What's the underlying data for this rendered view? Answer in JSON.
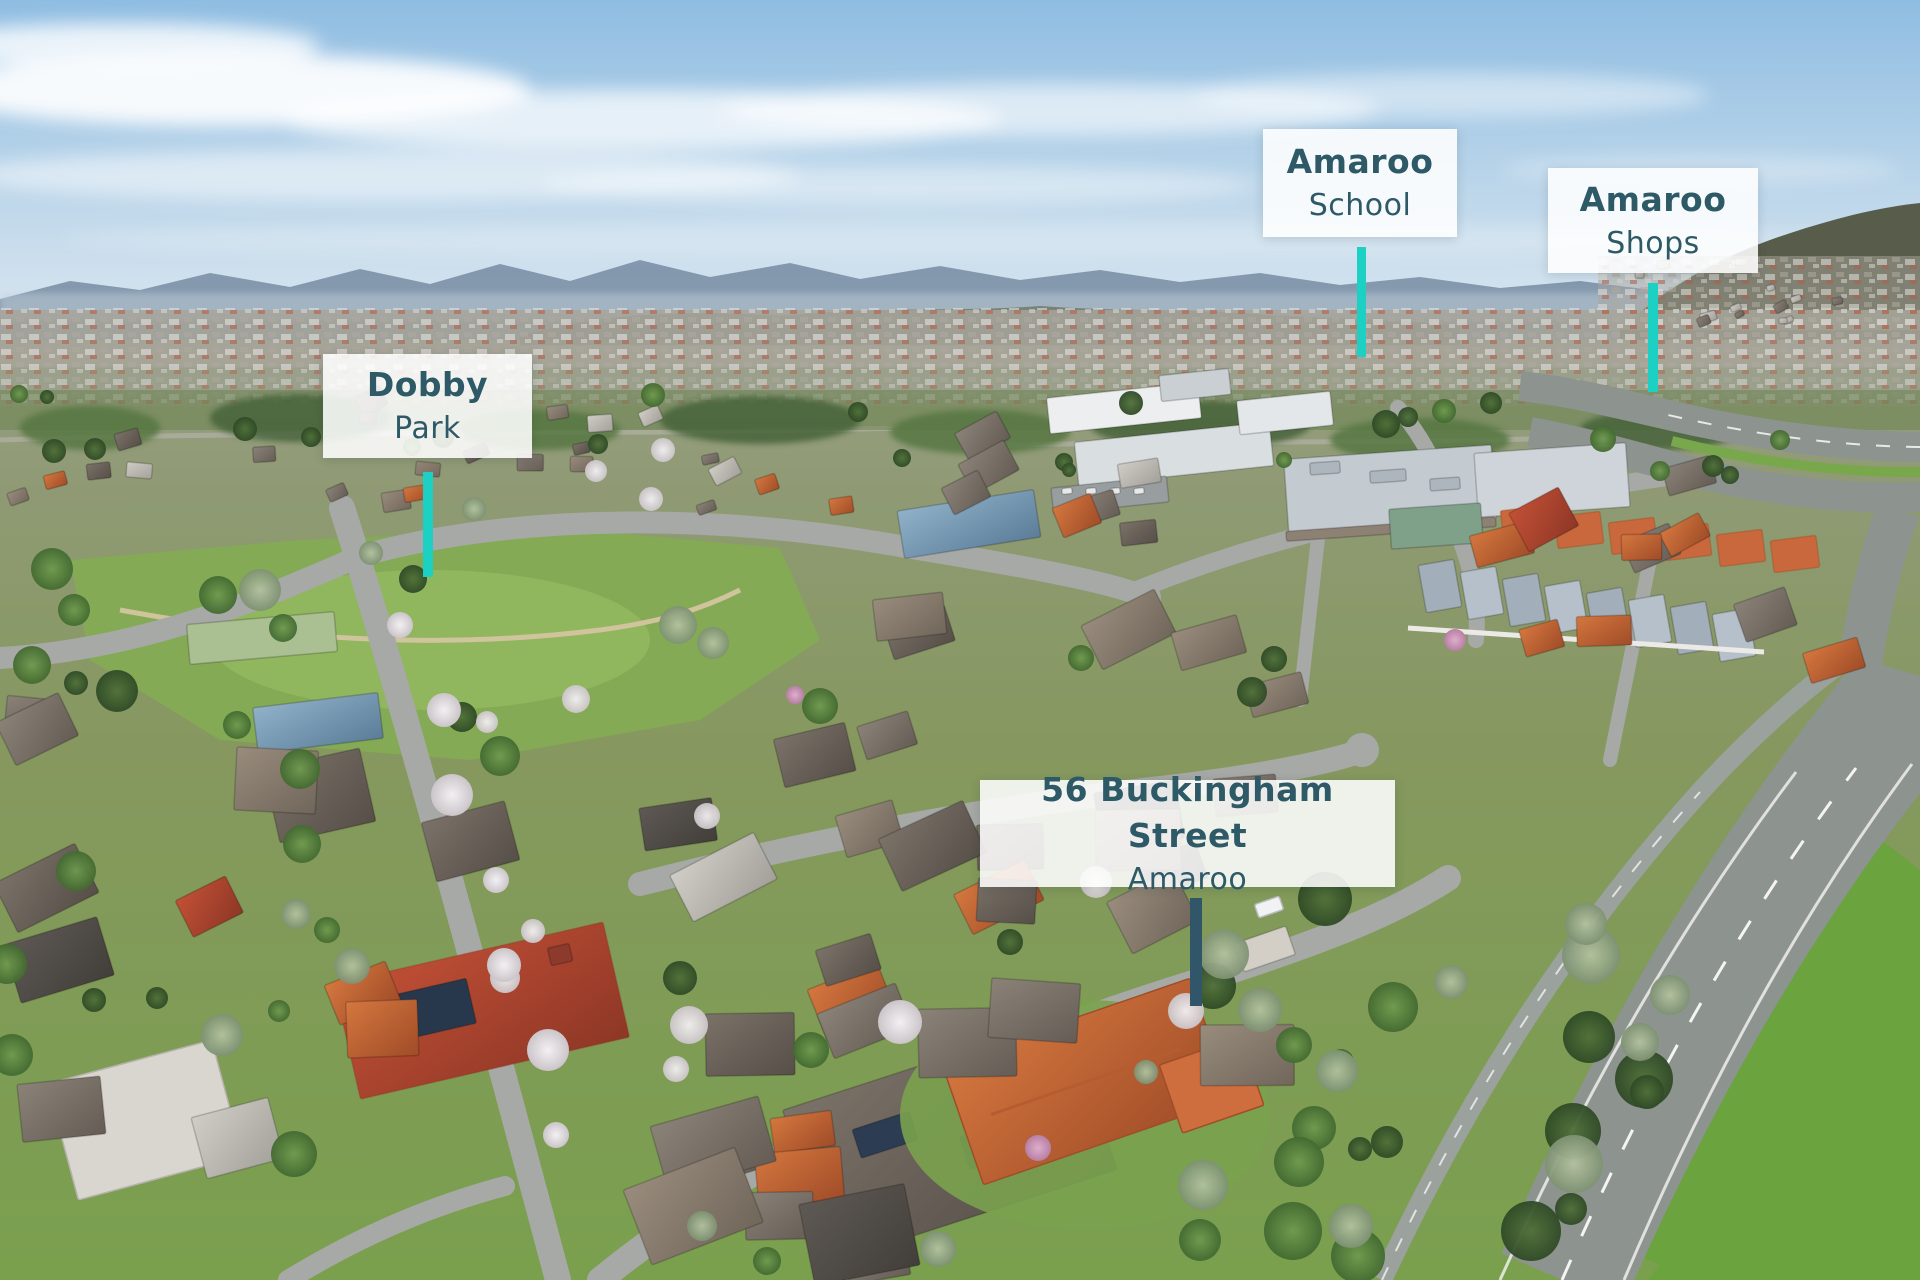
{
  "callouts": {
    "dobby_park": {
      "line1": "Dobby",
      "line2": "Park"
    },
    "amaroo_school": {
      "line1": "Amaroo",
      "line2": "School"
    },
    "amaroo_shops": {
      "line1": "Amaroo",
      "line2": "Shops"
    },
    "property": {
      "line1": "56 Buckingham Street",
      "line2": "Amaroo"
    }
  },
  "colors": {
    "pointer_teal": "#1DD0C4",
    "pointer_dark": "#315669",
    "label_text": "#2E5966",
    "label_background": "rgba(255,255,255,0.87)"
  }
}
